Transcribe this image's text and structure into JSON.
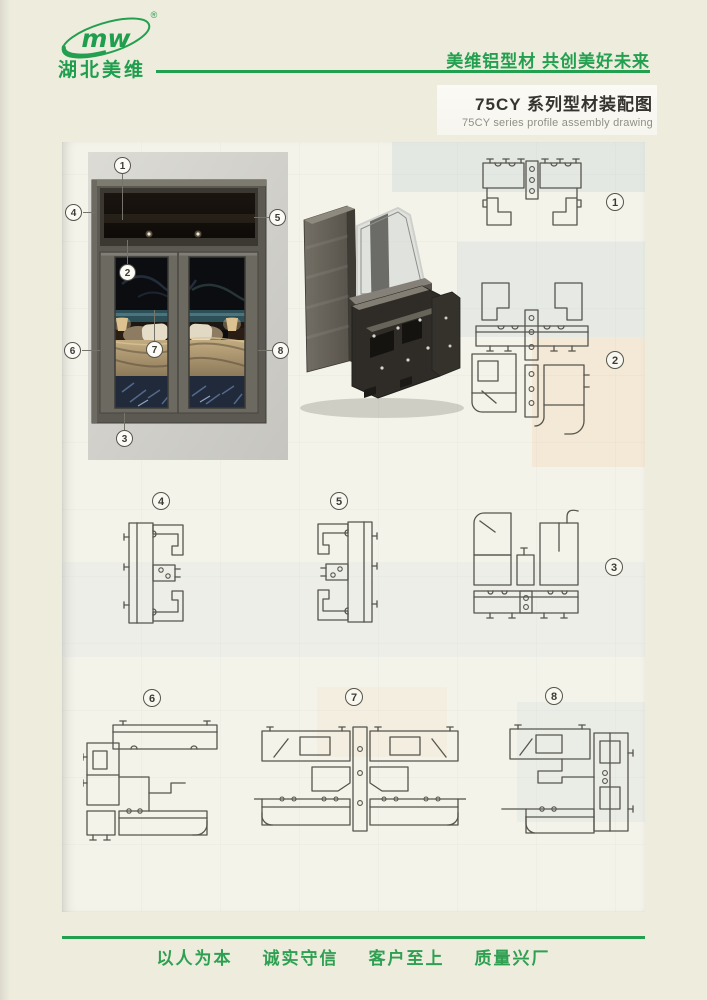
{
  "brand": {
    "logo_text": "mw",
    "registered_mark": "®",
    "name": "湖北美维",
    "slogan": "美维铝型材 共创美好未来"
  },
  "title": {
    "zh": "75CY 系列型材装配图",
    "en": "75CY series profile assembly drawing"
  },
  "window_figure": {
    "callouts": [
      "1",
      "2",
      "3",
      "4",
      "5",
      "6",
      "7",
      "8"
    ]
  },
  "diagrams": [
    {
      "label": "1"
    },
    {
      "label": "2"
    },
    {
      "label": "3"
    },
    {
      "label": "4"
    },
    {
      "label": "5"
    },
    {
      "label": "6"
    },
    {
      "label": "7"
    },
    {
      "label": "8"
    }
  ],
  "footer": {
    "motto": [
      "以人为本",
      "诚实守信",
      "客户至上",
      "质量兴厂"
    ]
  },
  "colors": {
    "brand_green": "#23a04f",
    "page_background": "#edecdd",
    "sheet_background": "#f4f3ea",
    "title_text": "#35342f",
    "subtitle_text": "#908e85",
    "diagram_ink": "#56554d",
    "window_frame_gray": "#5c5952"
  }
}
